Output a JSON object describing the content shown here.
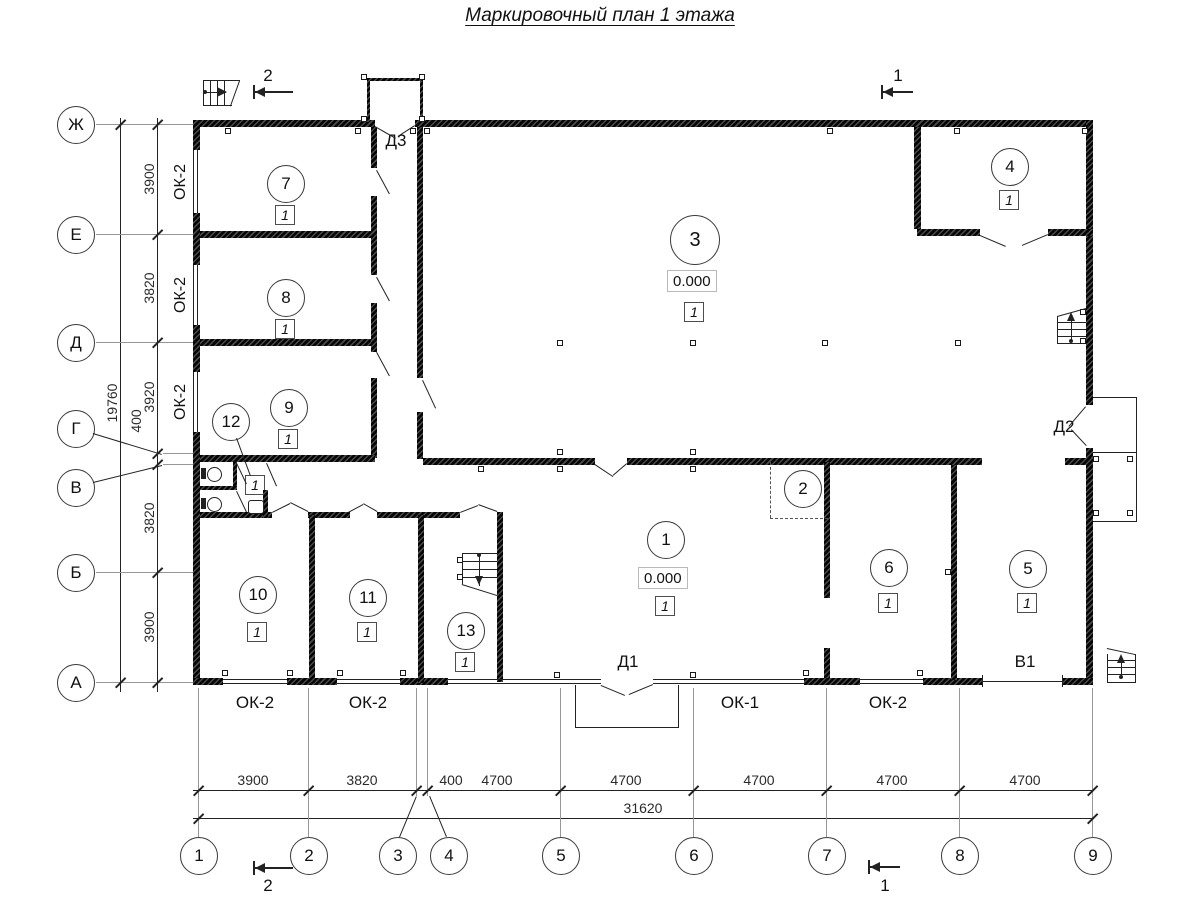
{
  "title": "Маркировочный план 1 этажа",
  "axes_left": [
    "Ж",
    "Е",
    "Д",
    "Г",
    "В",
    "Б",
    "А"
  ],
  "axes_bottom": [
    "1",
    "2",
    "3",
    "4",
    "5",
    "6",
    "7",
    "8",
    "9"
  ],
  "dims": {
    "left": [
      "3900",
      "3820",
      "3920",
      "400",
      "3820",
      "3900"
    ],
    "left_total": "19760",
    "bottom": [
      "3900",
      "3820",
      "400",
      "4700",
      "4700",
      "4700",
      "4700",
      "4700"
    ],
    "bottom_total": "31620"
  },
  "rooms": {
    "r1": {
      "num": "1",
      "elev": "0.000",
      "cat": "1"
    },
    "r2": {
      "num": "2"
    },
    "r3": {
      "num": "3",
      "elev": "0.000",
      "cat": "1"
    },
    "r4": {
      "num": "4",
      "cat": "1"
    },
    "r5": {
      "num": "5",
      "cat": "1"
    },
    "r6": {
      "num": "6",
      "cat": "1"
    },
    "r7": {
      "num": "7",
      "cat": "1"
    },
    "r8": {
      "num": "8",
      "cat": "1"
    },
    "r9": {
      "num": "9",
      "cat": "1"
    },
    "r10": {
      "num": "10",
      "cat": "1"
    },
    "r11": {
      "num": "11",
      "cat": "1"
    },
    "r12": {
      "num": "12",
      "cat": "1"
    },
    "r13": {
      "num": "13",
      "cat": "1"
    }
  },
  "windows": {
    "left": [
      "ОК-2",
      "ОК-2",
      "ОК-2"
    ],
    "bottom": [
      "ОК-2",
      "ОК-2",
      "ОК-1",
      "ОК-2"
    ]
  },
  "doors": {
    "d1": "Д1",
    "d2": "Д2",
    "d3": "Д3",
    "v1": "В1"
  },
  "sections": {
    "top_left": "2",
    "top_right": "1",
    "bottom_left": "2",
    "bottom_right": "1"
  }
}
